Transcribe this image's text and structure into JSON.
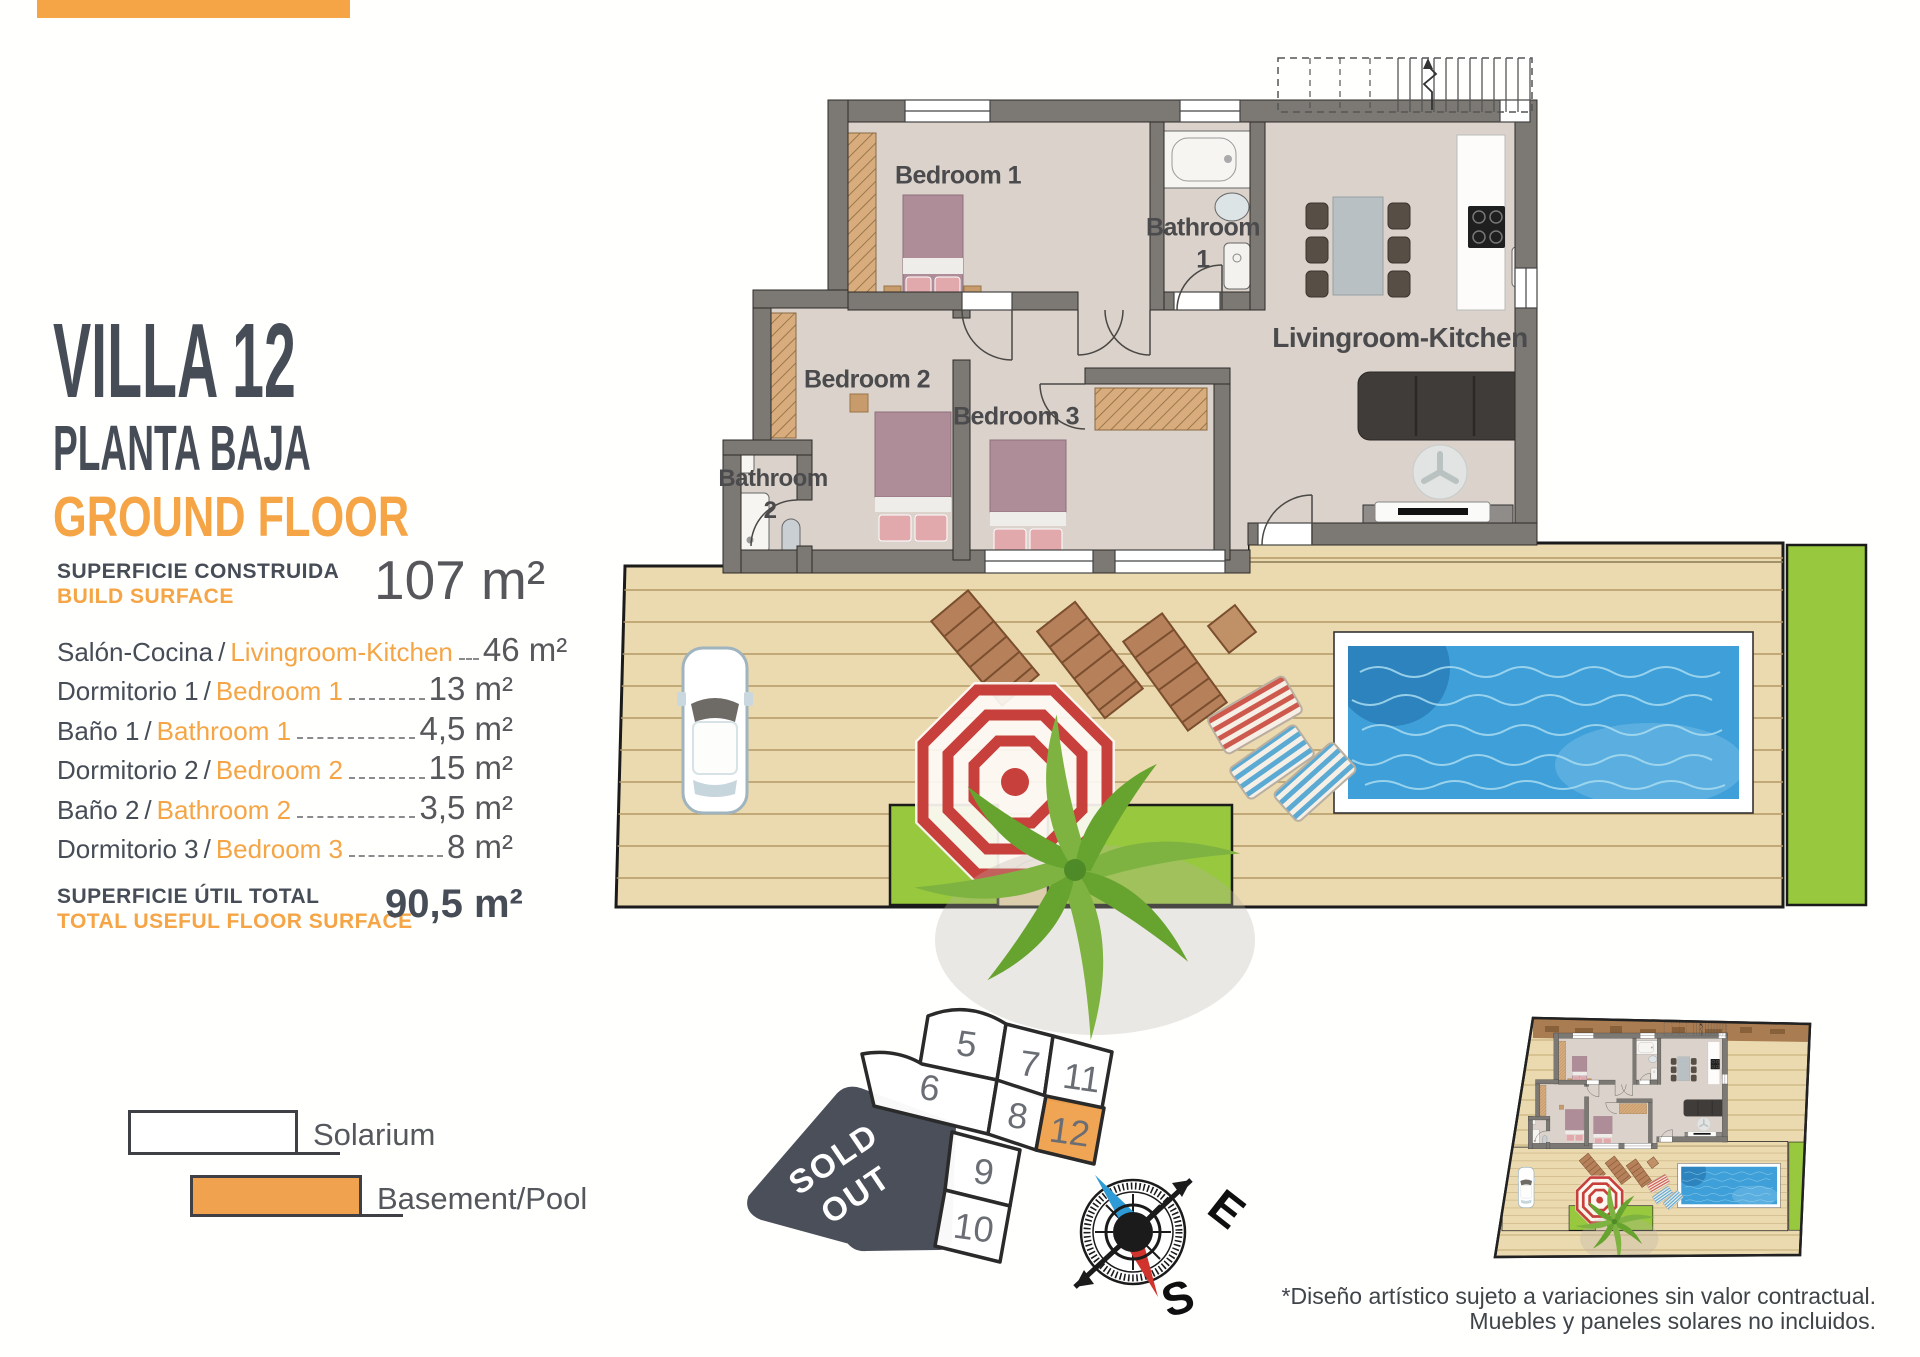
{
  "accent_color": "#F5A546",
  "title": {
    "name": "VILLA 12",
    "subtitle_es": "PLANTA BAJA",
    "subtitle_en": "GROUND FLOOR"
  },
  "build_surface": {
    "label_es": "SUPERFICIE CONSTRUIDA",
    "label_en": "BUILD SURFACE",
    "value": "107 m²"
  },
  "room_table": {
    "rows": [
      {
        "es": "Salón-Cocina",
        "en": "Livingroom-Kitchen",
        "area": "46 m²"
      },
      {
        "es": "Dormitorio 1",
        "en": "Bedroom 1",
        "area": "13 m²"
      },
      {
        "es": "Baño 1",
        "en": "Bathroom 1",
        "area": "4,5 m²"
      },
      {
        "es": "Dormitorio 2",
        "en": "Bedroom 2",
        "area": "15 m²"
      },
      {
        "es": "Baño 2",
        "en": "Bathroom 2",
        "area": "3,5 m²"
      },
      {
        "es": "Dormitorio 3",
        "en": "Bedroom 3",
        "area": "8 m²"
      }
    ]
  },
  "total": {
    "label_es": "SUPERFICIE ÚTIL TOTAL",
    "label_en": "TOTAL USEFUL FLOOR SURFACE",
    "value": "90,5 m²"
  },
  "legend": {
    "items": [
      {
        "label": "Solarium",
        "fill": "#FFFFFF"
      },
      {
        "label": "Basement/Pool",
        "fill": "#F0A24E"
      }
    ]
  },
  "plan_labels": {
    "bedroom1": "Bedroom 1",
    "bathroom1_line1": "Bathroom",
    "bathroom1_line2": "1",
    "bedroom2": "Bedroom 2",
    "bedroom3": "Bedroom 3",
    "bathroom2_line1": "Bathroom",
    "bathroom2_line2": "2",
    "livingroom": "Livingroom-Kitchen"
  },
  "plot_map": {
    "plots": [
      {
        "number": "5"
      },
      {
        "number": "6"
      },
      {
        "number": "7"
      },
      {
        "number": "8"
      },
      {
        "number": "9"
      },
      {
        "number": "10"
      },
      {
        "number": "11"
      },
      {
        "number": "12"
      }
    ],
    "highlighted_plot": "12",
    "highlight_color": "#F0A24E",
    "sold_out_line1": "SOLD",
    "sold_out_line2": "OUT"
  },
  "compass": {
    "east_label": "E",
    "south_label": "S"
  },
  "disclaimer": {
    "line1": "*Diseño artístico sujeto a variaciones sin valor contractual.",
    "line2": "Muebles y paneles solares no incluidos."
  }
}
